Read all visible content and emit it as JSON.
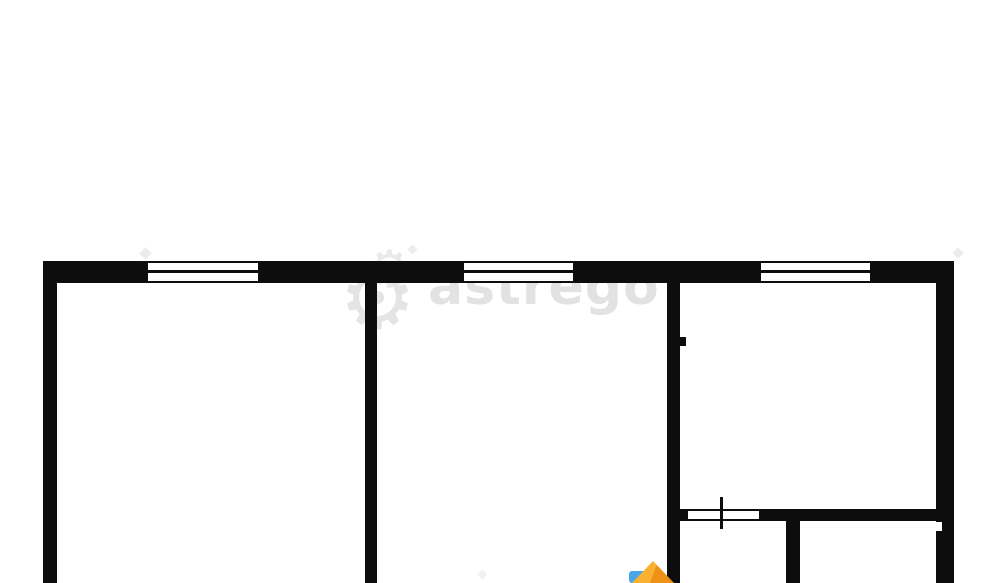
{
  "watermark": {
    "brand_text": "astrego",
    "gear_glyph": "⚙",
    "text_color": "#e2e2e2"
  },
  "floor_plan": {
    "type": "apartment-floor-plan",
    "wall_color": "#0d0d0d",
    "background_color": "#ffffff",
    "window_count": 3,
    "door_opening_count": 1,
    "visible_room_areas": 5
  },
  "logo_mark": {
    "blue": "#4ba6e9",
    "orange_light": "#f9b132",
    "orange_dark": "#ee9117"
  }
}
